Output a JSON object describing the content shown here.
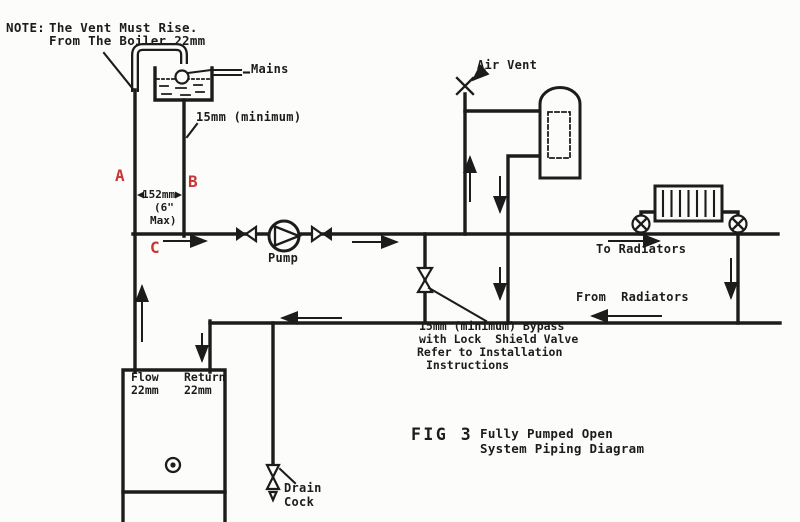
{
  "colors": {
    "ink": "#1c1c1c",
    "accent_red": "#c93434",
    "paper": "#fcfcfa"
  },
  "note": {
    "prefix": "NOTE:",
    "line1": "The Vent Must Rise.",
    "line2": "From The Boiler 22mm"
  },
  "tank": {
    "mains_label": "Mains",
    "feed_size_label": "15mm (minimum)"
  },
  "vent": {
    "air_vent_label": "Air Vent"
  },
  "points": {
    "a": "A",
    "b": "B",
    "c": "C"
  },
  "dimension": {
    "width": "152mm",
    "max_line1": "(6\"",
    "max_line2": "Max)"
  },
  "pump": {
    "label": "Pump"
  },
  "radiators": {
    "to_label": "To Radiators",
    "from_label": "From  Radiators"
  },
  "bypass": {
    "line1": "15mm (minimum) Bypass",
    "line2": "with Lock  Shield Valve",
    "line3": "Refer to Installation",
    "line4": "Instructions"
  },
  "boiler": {
    "flow_label": "Flow",
    "flow_size": "22mm",
    "return_label": "Return",
    "return_size": "22mm"
  },
  "drain": {
    "line1": "Drain",
    "line2": "Cock"
  },
  "caption": {
    "fig": "FIG 3",
    "line1": "Fully Pumped Open",
    "line2": "System Piping Diagram"
  }
}
